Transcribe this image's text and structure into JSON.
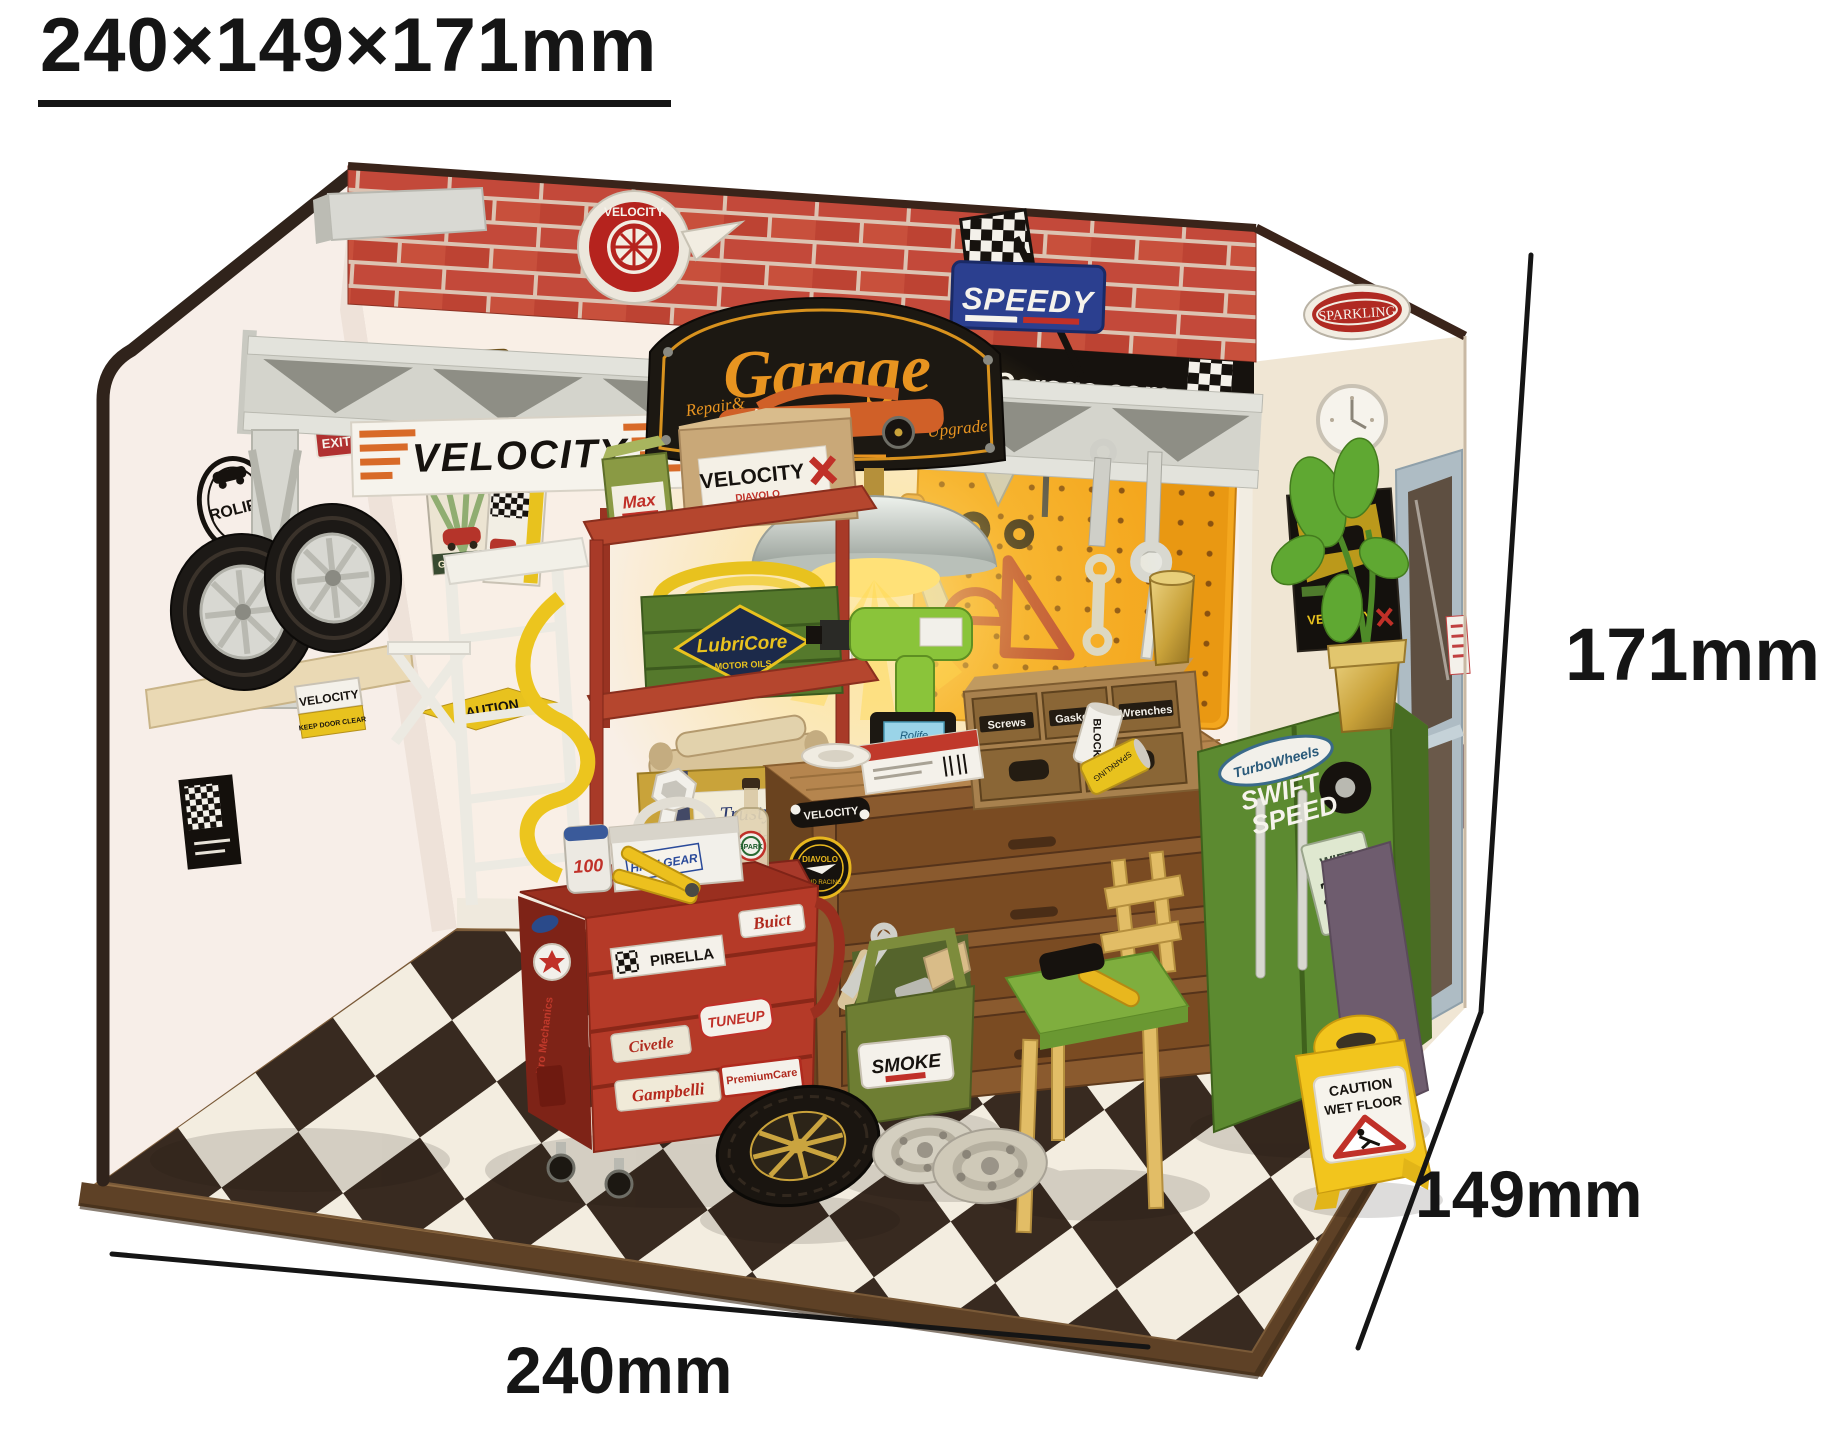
{
  "title": "240×149×171mm",
  "dims": {
    "width": "240mm",
    "depth": "149mm",
    "height": "171mm"
  },
  "brand": {
    "velocity_badge": "VELOCITY",
    "speedy": "SPEEDY",
    "sparkling": "SPARKLING",
    "garage_url": "Garage.com",
    "ecto_plate": "ECTO-1",
    "velocity_banner": "VELOCITY",
    "exit": "EXIT",
    "rolife": "ROLIFE",
    "gasoline": "GASOLINE",
    "caution_wall": "CAUTION",
    "keep_door_top": "VELOCITY",
    "keep_door_bottom": "KEEP DOOR CLEAR",
    "velocity_poster": "VELOCITY"
  },
  "sign": {
    "title": "Garage",
    "sub_left": "Repair&",
    "sub_right": "Upgrade",
    "year": "1890"
  },
  "shelf": {
    "max": "Max",
    "velocity_brand": "VELOCITY",
    "velocity_sub": "DIAVOLO",
    "lubricore_brand": "LubriCore",
    "lubricore_sub": "MOTOR OILS",
    "trusty_line1": "Trusty",
    "trusty_line2": "Tools"
  },
  "bench": {
    "drawer_labels": [
      "Screws",
      "Gaskets",
      "Wrenches"
    ],
    "velocity_sticker": "VELOCITY",
    "badge_top": "DIAVOLO",
    "badge_bottom": "RAPID RACING",
    "drill_label": "Rolife",
    "can_block": "BLOCK",
    "can_yellow": "SPARKLING"
  },
  "cabinet": {
    "logo_top": "TurboWheels",
    "logo_mid": "SWIFT",
    "logo_bot": "SPEED",
    "plate_l1": "WIFT",
    "plate_l2": "221",
    "plate_l3": "FLEET"
  },
  "cart": {
    "pirella": "PIRELLA",
    "buict": "Buict",
    "tuneup": "TUNEUP",
    "civetle": "Civetle",
    "gampbelli": "Gampbelli",
    "premiumcare": "PremiumCare",
    "pro_mech": "Pro Mechanics",
    "oil_can": "100",
    "caddy": "HIGH GEAR",
    "bottle": "SPARK"
  },
  "left": {
    "fixit": "FIXIT",
    "seventysix": "76",
    "jar": "MECHA",
    "service": "Service"
  },
  "smoke": {
    "label": "SMOKE"
  },
  "wetfloor": {
    "l1": "CAUTION",
    "l2": "WET FLOOR"
  },
  "colors": {
    "brick": "#c3493a",
    "pegboard": "#f4a71e",
    "cart_red": "#b53a28",
    "cabinet_green": "#5c8a30",
    "shelf_red": "#b5462e",
    "floor_dark": "#382a20",
    "floor_light": "#f3ede0",
    "caution_yellow": "#f2c51d",
    "dimension_line": "#151515"
  }
}
